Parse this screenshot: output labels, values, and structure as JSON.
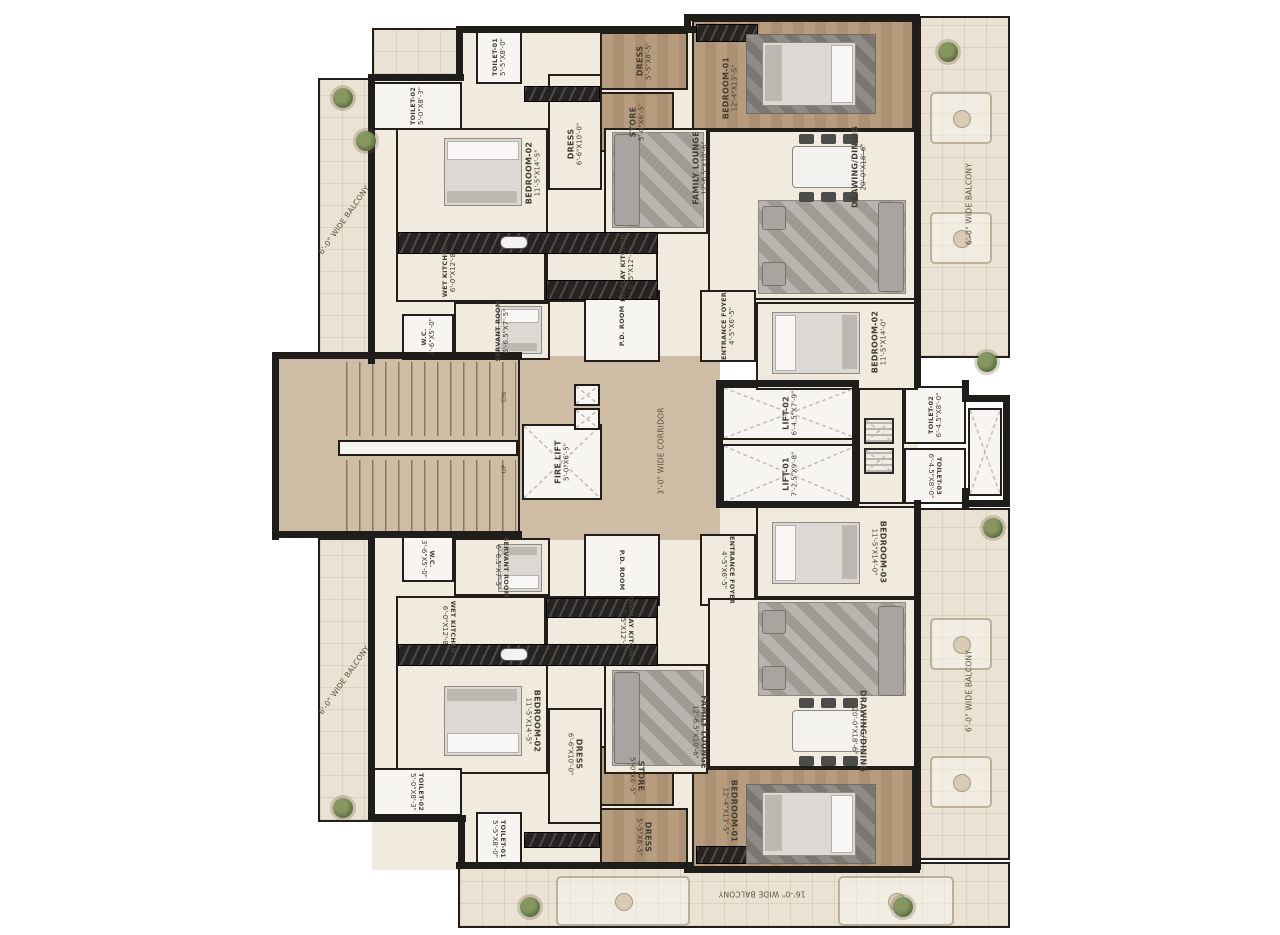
{
  "plan_title": "Typical Floor Plan",
  "stairs": {
    "up_label": "UP",
    "dn_label": "DN"
  },
  "rooms": [
    {
      "id": "bg-unit-top",
      "x": 372,
      "y": 28,
      "w": 546,
      "h": 334,
      "floor": "cream",
      "bg": true
    },
    {
      "id": "bg-unit-bottom",
      "x": 372,
      "y": 538,
      "w": 546,
      "h": 332,
      "floor": "cream",
      "bg": true
    },
    {
      "id": "bg-unit-bottom2",
      "x": 584,
      "y": 505,
      "w": 334,
      "h": 40,
      "floor": "cream",
      "bg": true
    },
    {
      "id": "bg-core",
      "x": 520,
      "y": 356,
      "w": 200,
      "h": 184,
      "floor": "tan",
      "bg": true
    },
    {
      "id": "bg-lift-lobby",
      "x": 720,
      "y": 380,
      "w": 198,
      "h": 128,
      "floor": "cream",
      "bg": true
    },
    {
      "id": "balcony-left-top",
      "name": "6'-0\" WIDE BALCONY",
      "x": 318,
      "y": 78,
      "w": 52,
      "h": 284,
      "floor": "tile",
      "rot": -55,
      "plain": true
    },
    {
      "id": "balcony-left-bottom",
      "name": "6'-0\" WIDE BALCONY",
      "x": 318,
      "y": 538,
      "w": 52,
      "h": 284,
      "floor": "tile",
      "rot": -55,
      "plain": true
    },
    {
      "id": "terrace-right-top",
      "name": "6'-0\" WIDE BALCONY",
      "x": 918,
      "y": 16,
      "w": 92,
      "h": 342,
      "floor": "tile",
      "rot": -90,
      "plain": true,
      "lx": 55,
      "ly": 55
    },
    {
      "id": "terrace-right-bottom",
      "name": "6'-0\" WIDE BALCONY",
      "x": 918,
      "y": 508,
      "w": 92,
      "h": 352,
      "floor": "tile",
      "rot": -90,
      "plain": true,
      "lx": 55,
      "ly": 52
    },
    {
      "id": "balcony-bottom",
      "name": "16'-0\" WIDE BALCONY",
      "x": 458,
      "y": 862,
      "w": 552,
      "h": 66,
      "floor": "tile",
      "rot": 180,
      "plain": true,
      "lx": 55,
      "ly": 48
    },
    {
      "id": "balcony-top-left-mini",
      "x": 372,
      "y": 28,
      "w": 88,
      "h": 48,
      "floor": "tile"
    },
    {
      "id": "stairs",
      "x": 274,
      "y": 356,
      "w": 246,
      "h": 182,
      "floor": "tan"
    },
    {
      "id": "corridor",
      "name": "3'-0\" WIDE CORRIDOR",
      "x": 602,
      "y": 362,
      "w": 118,
      "h": 178,
      "floor": "none",
      "rot": -90,
      "plain": true
    },
    {
      "id": "fire-lift",
      "name": "FIRE LIFT",
      "dims": "5'-0\"X6'-5\"",
      "x": 522,
      "y": 424,
      "w": 80,
      "h": 76,
      "floor": "marble",
      "rot": -90,
      "cross": true
    },
    {
      "id": "lift-02",
      "name": "LIFT-02",
      "dims": "6'-4.5\"X7'-9\"",
      "x": 722,
      "y": 386,
      "w": 136,
      "h": 54,
      "floor": "marble",
      "rot": -90,
      "cross": true
    },
    {
      "id": "lift-01",
      "name": "LIFT-01",
      "dims": "7'-2.5\"X9'-8\"",
      "x": 722,
      "y": 444,
      "w": 136,
      "h": 60,
      "floor": "marble",
      "rot": -90,
      "cross": true
    },
    {
      "id": "lift-lobby",
      "x": 858,
      "y": 386,
      "w": 46,
      "h": 118,
      "floor": "cream"
    },
    {
      "id": "toilet-02-right",
      "name": "TOILET-02",
      "dims": "6'-4.5\"X8'-0\"",
      "x": 904,
      "y": 386,
      "w": 62,
      "h": 58,
      "floor": "marble",
      "rot": -90,
      "tiny": true
    },
    {
      "id": "toilet-03-right",
      "name": "TOILET-03",
      "dims": "6'-4.5\"X8'-0\"",
      "x": 904,
      "y": 448,
      "w": 62,
      "h": 56,
      "floor": "marble",
      "rot": 90,
      "tiny": true
    },
    {
      "id": "duct-right",
      "x": 968,
      "y": 408,
      "w": 34,
      "h": 88,
      "floor": "marble",
      "cross": true
    },
    {
      "id": "toilet-02-top-left",
      "name": "TOILET-02",
      "dims": "5'-0\"X8'-3\"",
      "x": 372,
      "y": 82,
      "w": 90,
      "h": 48,
      "floor": "marble",
      "rot": -90,
      "tiny": true
    },
    {
      "id": "toilet-01-top",
      "name": "TOILET-01",
      "dims": "5'-5\"X8'-0\"",
      "x": 476,
      "y": 30,
      "w": 46,
      "h": 54,
      "floor": "marble",
      "rot": -90,
      "tiny": true
    },
    {
      "id": "bedroom-02-top-left",
      "name": "BEDROOM-02",
      "dims": "11'-5\"X14'-5\"",
      "x": 396,
      "y": 128,
      "w": 152,
      "h": 106,
      "floor": "cream",
      "rot": -90,
      "lx": 90,
      "ly": 42
    },
    {
      "id": "dress-top",
      "name": "DRESS",
      "dims": "6'-6\"X10'-0\"",
      "x": 548,
      "y": 74,
      "w": 54,
      "h": 116,
      "floor": "cream",
      "rot": -90,
      "ly": 60
    },
    {
      "id": "store-top",
      "name": "STORE",
      "dims": "5'-0\"X6'-5\"",
      "x": 600,
      "y": 92,
      "w": 74,
      "h": 60,
      "floor": "wood",
      "rot": -90
    },
    {
      "id": "dress-brown-top",
      "name": "DRESS",
      "dims": "5'-5\"X8'-5\"",
      "x": 600,
      "y": 32,
      "w": 88,
      "h": 58,
      "floor": "wood",
      "rot": -90
    },
    {
      "id": "bedroom-01-top",
      "name": "BEDROOM-01",
      "dims": "12'-4\"X13'-5\"",
      "x": 692,
      "y": 20,
      "w": 222,
      "h": 110,
      "floor": "wood",
      "rot": -90,
      "lx": 17,
      "ly": 62
    },
    {
      "id": "family-lounge-top",
      "name": "FAMILY LOUNGE",
      "dims": "12'-6.5\"X10'-6\"",
      "x": 604,
      "y": 128,
      "w": 104,
      "h": 106,
      "floor": "cream",
      "rot": -90,
      "lx": 92,
      "ly": 38
    },
    {
      "id": "drawing-dining-top",
      "name": "DRAWING/DINING",
      "dims": "20'-0\"X18'-6\"",
      "x": 708,
      "y": 130,
      "w": 210,
      "h": 170,
      "floor": "cream",
      "rot": -90,
      "lx": 72,
      "ly": 22
    },
    {
      "id": "wet-kitchen-top",
      "name": "WET KITCHEN",
      "dims": "6'-0\"X12'-8\"",
      "x": 396,
      "y": 234,
      "w": 150,
      "h": 68,
      "floor": "cream",
      "rot": -90,
      "lx": 35,
      "ly": 55,
      "tiny": true
    },
    {
      "id": "display-kitchen-top",
      "name": "DISPLAY KITCHEN",
      "dims": "8'-5\"X12'-8\"",
      "x": 546,
      "y": 234,
      "w": 112,
      "h": 68,
      "floor": "cream",
      "rot": -90,
      "lx": 72,
      "ly": 50,
      "tiny": true
    },
    {
      "id": "servant-room-top",
      "name": "SERVANT ROOM",
      "dims": "6'-6.5\"X7'-5\"",
      "x": 454,
      "y": 302,
      "w": 96,
      "h": 58,
      "floor": "cream",
      "rot": -90,
      "tiny": true
    },
    {
      "id": "wc-top",
      "name": "W.C.",
      "dims": "3'-6\"X5'-0\"",
      "x": 402,
      "y": 314,
      "w": 52,
      "h": 46,
      "floor": "marble",
      "rot": -90,
      "tiny": true
    },
    {
      "id": "pd-room-top",
      "name": "P.D. ROOM",
      "x": 584,
      "y": 290,
      "w": 76,
      "h": 72,
      "floor": "marble",
      "rot": -90,
      "tiny": true
    },
    {
      "id": "entrance-foyer-top",
      "name": "ENTRANCE FOYER",
      "dims": "4'-5\"X6'-5\"",
      "x": 700,
      "y": 290,
      "w": 56,
      "h": 72,
      "floor": "cream",
      "rot": -90,
      "tiny": true
    },
    {
      "id": "bedroom-02-right",
      "name": "BEDROOM-02",
      "dims": "11'-5\"X14'-0\"",
      "x": 756,
      "y": 302,
      "w": 162,
      "h": 88,
      "floor": "cream",
      "rot": -90,
      "lx": 76,
      "ly": 45
    },
    {
      "id": "wc-bottom",
      "name": "W.C.",
      "dims": "3'-6\"X5'-0\"",
      "x": 402,
      "y": 536,
      "w": 52,
      "h": 46,
      "floor": "marble",
      "rot": 90,
      "tiny": true
    },
    {
      "id": "servant-room-bottom",
      "name": "SERVANT ROOM",
      "dims": "6'-6.5\"X7'-5\"",
      "x": 454,
      "y": 538,
      "w": 96,
      "h": 58,
      "floor": "cream",
      "rot": 90,
      "tiny": true
    },
    {
      "id": "pd-room-bottom",
      "name": "P.D. ROOM",
      "x": 584,
      "y": 534,
      "w": 76,
      "h": 72,
      "floor": "marble",
      "rot": 90,
      "tiny": true
    },
    {
      "id": "entrance-foyer-bottom",
      "name": "ENTRANCE FOYER",
      "dims": "4'-5\"X6'-5\"",
      "x": 700,
      "y": 534,
      "w": 56,
      "h": 72,
      "floor": "cream",
      "rot": 90,
      "tiny": true
    },
    {
      "id": "bedroom-03-right",
      "name": "BEDROOM-03",
      "dims": "11'-5\"X14'-0\"",
      "x": 756,
      "y": 506,
      "w": 162,
      "h": 92,
      "floor": "cream",
      "rot": 90,
      "lx": 76,
      "ly": 50
    },
    {
      "id": "display-kitchen-bottom",
      "name": "DISPLAY KITCHEN",
      "dims": "8'-5\"X12'-8\"",
      "x": 546,
      "y": 596,
      "w": 112,
      "h": 68,
      "floor": "cream",
      "rot": 90,
      "lx": 72,
      "ly": 50,
      "tiny": true
    },
    {
      "id": "wet-kitchen-bottom",
      "name": "WET KITCHEN",
      "dims": "6'-0\"X12'-8\"",
      "x": 396,
      "y": 596,
      "w": 150,
      "h": 68,
      "floor": "cream",
      "rot": 90,
      "lx": 35,
      "ly": 45,
      "tiny": true
    },
    {
      "id": "bedroom-02-bottom-left",
      "name": "BEDROOM-02",
      "dims": "11'-5\"X14'-5\"",
      "x": 396,
      "y": 664,
      "w": 152,
      "h": 110,
      "floor": "cream",
      "rot": 90,
      "lx": 90,
      "ly": 52
    },
    {
      "id": "dress-bottom",
      "name": "DRESS",
      "dims": "6'-6\"X10'-0\"",
      "x": 548,
      "y": 708,
      "w": 54,
      "h": 116,
      "floor": "cream",
      "rot": 90,
      "ly": 40
    },
    {
      "id": "store-bottom",
      "name": "STORE",
      "dims": "5'-0\"X6'-5\"",
      "x": 600,
      "y": 746,
      "w": 74,
      "h": 60,
      "floor": "wood",
      "rot": 90
    },
    {
      "id": "dress-brown-bottom",
      "name": "DRESS",
      "dims": "5'-5\"X8'-5\"",
      "x": 600,
      "y": 808,
      "w": 88,
      "h": 58,
      "floor": "wood",
      "rot": 90
    },
    {
      "id": "bedroom-01-bottom",
      "name": "BEDROOM-01",
      "dims": "12'-4\"X13'-5\"",
      "x": 692,
      "y": 768,
      "w": 222,
      "h": 102,
      "floor": "wood",
      "rot": 90,
      "lx": 17,
      "ly": 42
    },
    {
      "id": "family-lounge-bottom",
      "name": "FAMILY LOUNGE",
      "dims": "12'-6.5\"X10'-6\"",
      "x": 604,
      "y": 664,
      "w": 104,
      "h": 110,
      "floor": "cream",
      "rot": 90,
      "lx": 92,
      "ly": 62
    },
    {
      "id": "drawing-dining-bottom",
      "name": "DRAWING/DINING",
      "dims": "20'-0\"X18'-6\"",
      "x": 708,
      "y": 598,
      "w": 210,
      "h": 170,
      "floor": "cream",
      "rot": 90,
      "lx": 72,
      "ly": 78
    },
    {
      "id": "toilet-02-bottom-left",
      "name": "TOILET-02",
      "dims": "5'-0\"X8'-3\"",
      "x": 372,
      "y": 768,
      "w": 90,
      "h": 48,
      "floor": "marble",
      "rot": 90,
      "tiny": true
    },
    {
      "id": "toilet-01-bottom",
      "name": "TOILET-01",
      "dims": "5'-5\"X8'-0\"",
      "x": 476,
      "y": 812,
      "w": 46,
      "h": 54,
      "floor": "marble",
      "rot": 90,
      "tiny": true
    },
    {
      "id": "stairs-up-label",
      "name": "UP",
      "x": 494,
      "y": 458,
      "w": 20,
      "h": 22,
      "floor": "none",
      "rot": -90,
      "plain": true,
      "tiny": true
    },
    {
      "id": "stairs-dn-label",
      "name": "DN",
      "x": 494,
      "y": 386,
      "w": 20,
      "h": 22,
      "floor": "none",
      "rot": -90,
      "plain": true,
      "tiny": true
    }
  ]
}
